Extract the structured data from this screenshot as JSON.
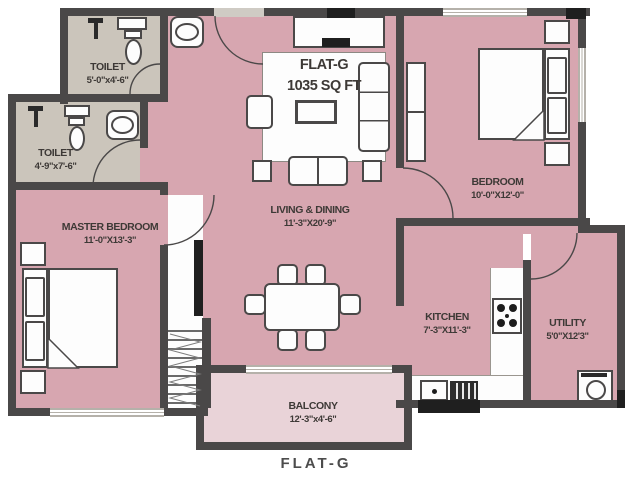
{
  "title": {
    "name": "FLAT-G",
    "area": "1035 SQ FT"
  },
  "caption": "FLAT-G",
  "rooms": {
    "toilet_top": {
      "name": "TOILET",
      "dims": "5'-0\"x4'-6\""
    },
    "toilet_left": {
      "name": "TOILET",
      "dims": "4'-9\"x7'-6\""
    },
    "master_bedroom": {
      "name": "MASTER BEDROOM",
      "dims": "11'-0\"X13'-3\""
    },
    "living_dining": {
      "name": "LIVING & DINING",
      "dims": "11'-3\"X20'-9\""
    },
    "bedroom": {
      "name": "BEDROOM",
      "dims": "10'-0\"X12'-0\""
    },
    "kitchen": {
      "name": "KITCHEN",
      "dims": "7'-3\"X11'-3\""
    },
    "utility": {
      "name": "UTILITY",
      "dims": "5'0\"X12'3\""
    },
    "balcony": {
      "name": "BALCONY",
      "dims": "12'-3\"x4'-6\""
    }
  },
  "colors": {
    "room_fill": "#d7a6b0",
    "balcony_fill": "#e9d3d8",
    "toilet_fill": "#cbc5bb",
    "wall": "#4a4848",
    "accent_dark": "#1f1f1f",
    "window": "#b5b1aa",
    "furniture_line": "#4a4848",
    "text": "#3d3936",
    "background": "#ffffff"
  }
}
